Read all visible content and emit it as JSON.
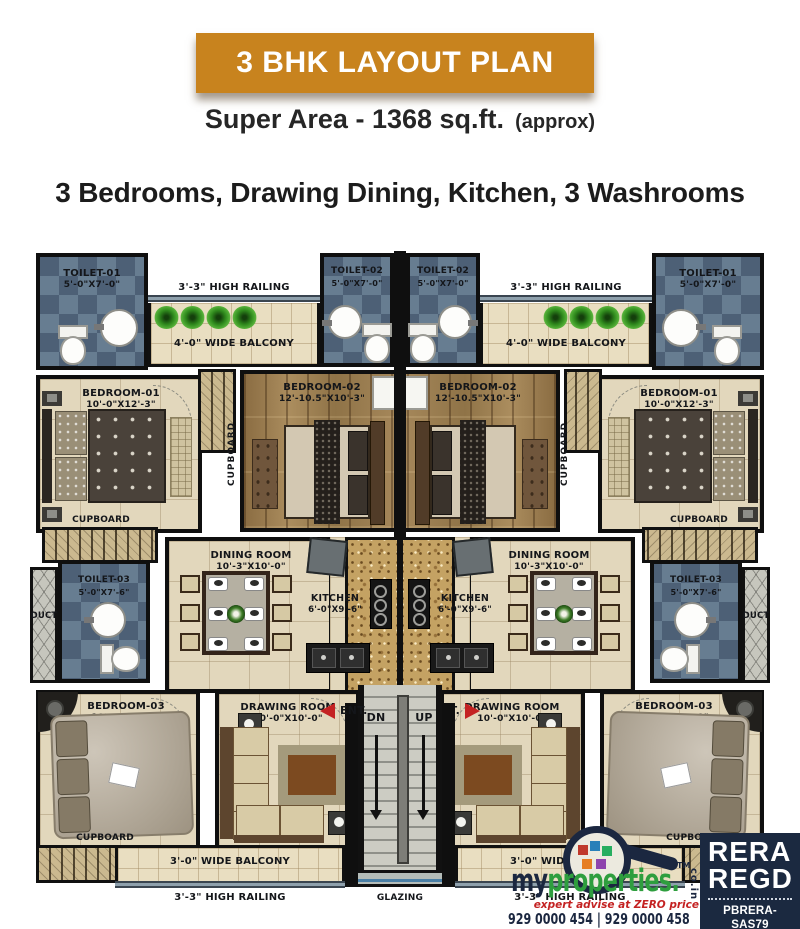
{
  "header": {
    "title": "3 BHK LAYOUT PLAN",
    "super_area": "Super Area - 1368  sq.ft.",
    "approx": "(approx)",
    "features": "3 Bedrooms, Drawing Dining, Kitchen, 3 Washrooms"
  },
  "plan": {
    "rooms": {
      "toilet1": {
        "name": "TOILET-01",
        "dims": "5'-0\"X7'-0\""
      },
      "toilet2": {
        "name": "TOILET-02",
        "dims": "5'-0\"X7'-0\""
      },
      "toilet3": {
        "name": "TOILET-03",
        "dims": "5'-0\"X7'-6\""
      },
      "bedroom1": {
        "name": "BEDROOM-01",
        "dims": "10'-0\"X12'-3\""
      },
      "bedroom2": {
        "name": "BEDROOM-02",
        "dims": "12'-10.5\"X10'-3\""
      },
      "bedroom3": {
        "name": "BEDROOM-03",
        "dims": "10'-0\"X12'-0\""
      },
      "dining": {
        "name": "DINING ROOM",
        "dims": "10'-3\"X10'-0\""
      },
      "kitchen": {
        "name": "KITCHEN",
        "dims": "6'-0\"X9'-6\""
      },
      "drawing": {
        "name": "DRAWING ROOM",
        "dims": "10'-0\"X10'-0\""
      }
    },
    "labels": {
      "high_railing": "3'-3\" HIGH RAILING",
      "balcony_top": "4'-0\" WIDE BALCONY",
      "balcony_bottom": "3'-0\" WIDE BALCONY",
      "cupboard": "CUPBOARD",
      "duct": "DUCT",
      "ent": "ENT.",
      "dn": "DN",
      "up": "UP",
      "glazing": "GLAZING"
    }
  },
  "footer": {
    "rera": {
      "line1": "RERA",
      "line2": "REGD",
      "reg1": "PBRERA-SAS79",
      "reg2": "REA0630"
    },
    "brand": {
      "prefix": "my",
      "suffix": "properties.",
      "tm": "TM",
      "domain": "co.in",
      "tagline": "expert advise at ZERO price",
      "phones": "929 0000 454 | 929 0000 458"
    }
  },
  "colors": {
    "banner_orange": "#C8831E",
    "rera_navy": "#1B2940",
    "brand_navy": "#1B2740",
    "brand_green": "#2E9E3E",
    "accent_red": "#C42222"
  }
}
